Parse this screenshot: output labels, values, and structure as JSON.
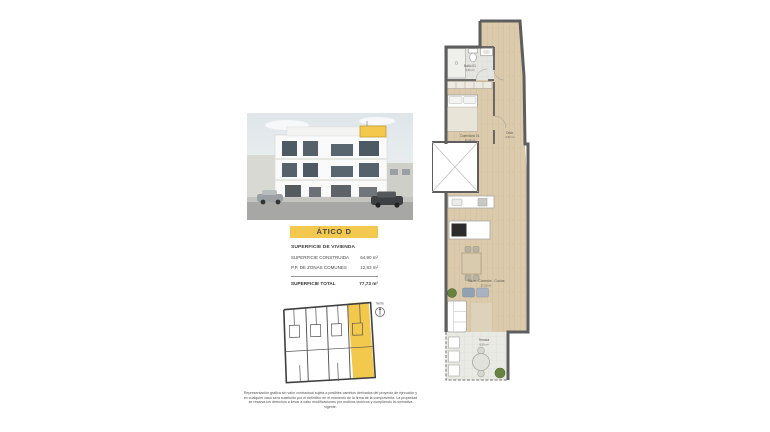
{
  "colors": {
    "accent_yellow": "#F2C94C",
    "wall_gray": "#5E5E5E",
    "wood_floor": "#DBCBAE"
  },
  "title_banner": {
    "label": "ÁTICO D"
  },
  "areas_table": {
    "header": "SUPERFICIE DE VIVIENDA",
    "rows": [
      {
        "label": "SUPERFICIE CONSTRUIDA",
        "value": "64,90 m²"
      },
      {
        "label": "P.P. DE ZONAS COMUNES",
        "value": "12,83 m²"
      }
    ],
    "total": {
      "label": "SUPERFICIE TOTAL",
      "value": "77,73 m²"
    }
  },
  "key_plan": {
    "north_label": "Norte"
  },
  "floor_plan": {
    "rooms": [
      {
        "name": "Baño 01",
        "area": "3,50 m²"
      },
      {
        "name": "Dormitorio 01",
        "area": "11,00 m²"
      },
      {
        "name": "Distr.",
        "area": "2,50 m²"
      },
      {
        "name": "Salón - Comedor - Cocina",
        "area": "27,00 m²"
      },
      {
        "name": "Terraza",
        "area": "8,50 m²"
      }
    ]
  },
  "disclaimer": {
    "text": "Representación gráfica sin valor contractual sujeta a posibles cambios derivados del proyecto de ejecución y en cualquier caso será sustituido por el definitivo en el momento de la firma de la compraventa. La propiedad se reserva los derechos a llevar a cabo modificaciones por motivos técnicos y cumpliendo la normativa vigente."
  }
}
